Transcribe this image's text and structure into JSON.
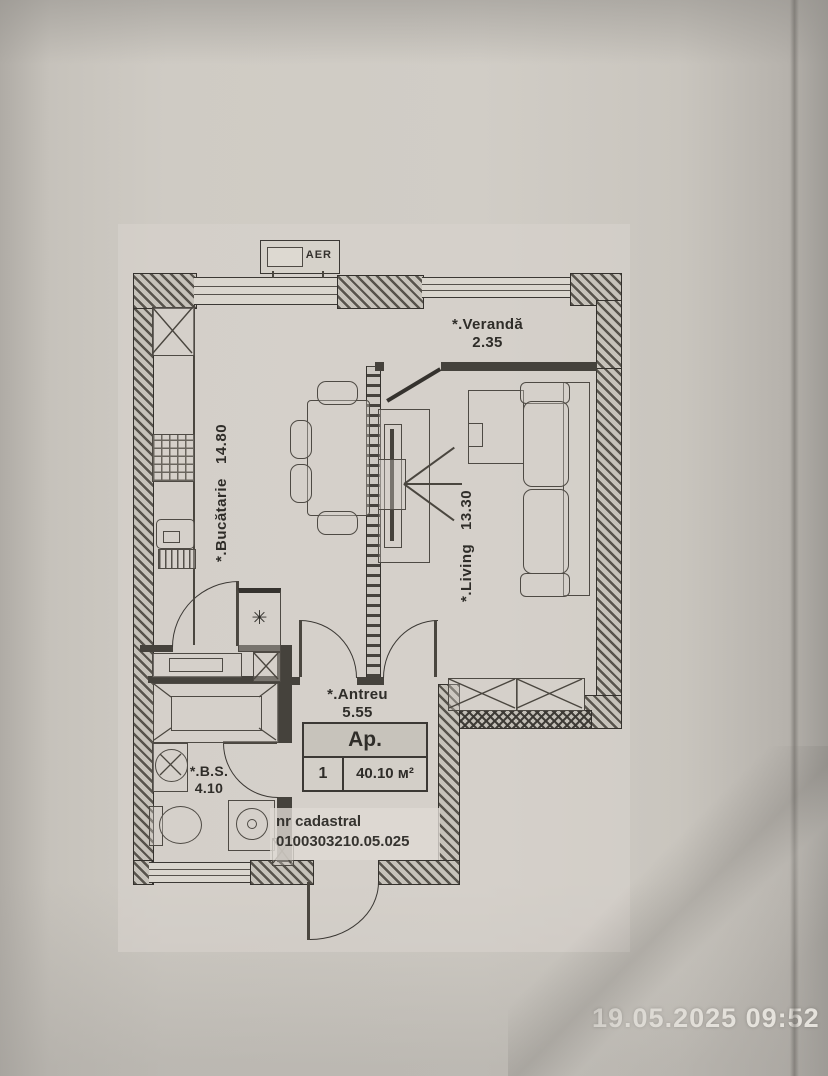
{
  "photo": {
    "timestamp": "19.05.2025 09:52"
  },
  "plan": {
    "ac_unit_label": "AER",
    "rooms": {
      "kitchen": {
        "label": "*.Bucătarie",
        "area": "14.80"
      },
      "veranda": {
        "label": "*.Verandă",
        "area": "2.35"
      },
      "living": {
        "label": "*.Living",
        "area": "13.30"
      },
      "hall": {
        "label": "*.Antreu",
        "area": "5.55"
      },
      "bathroom": {
        "label": "*.B.S.",
        "area": "4.10"
      }
    },
    "apartment_box": {
      "title": "Ap.",
      "number": "1",
      "total_area": "40.10 м²"
    },
    "cadastral": {
      "label": "nr cadastral",
      "number": "0100303210.05.025"
    },
    "vent_symbol": "✳"
  },
  "colors": {
    "ink": "#3b3834",
    "paper": "#cfcbc4",
    "wall_hatch": "#57534c",
    "timestamp_text": "#e5e2dc"
  }
}
